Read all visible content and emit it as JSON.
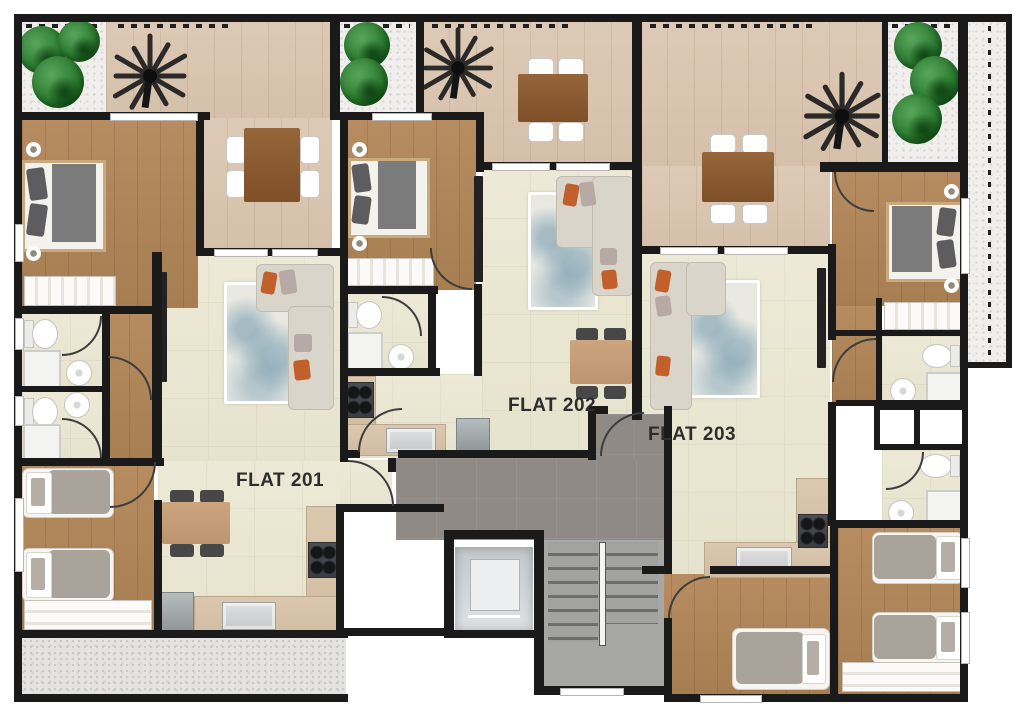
{
  "flats": [
    {
      "label": "FLAT 201"
    },
    {
      "label": "FLAT 202"
    },
    {
      "label": "FLAT 203"
    }
  ],
  "palette": {
    "wall": "#1a1a1a",
    "tile": "#ebe8d6",
    "wood": "#b68c60",
    "terrace": "#dcc8b3",
    "corridor": "#8f8a85",
    "stairs": "#a7a7a5",
    "gravel": "#efeeec",
    "green": "#2e7d32",
    "rug_blue": "#8fb3c0",
    "sofa": "#d9d5ca",
    "accent_orange": "#c2602c",
    "label": "#2d2d2d"
  },
  "icons": [
    "palm-tree",
    "shrub",
    "double-bed",
    "single-bed",
    "sofa",
    "dining-table",
    "chair",
    "toilet",
    "round-sink",
    "shower",
    "stove",
    "kitchen-sink",
    "fridge",
    "tv",
    "wardrobe",
    "elevator",
    "staircase",
    "rug",
    "door-swing"
  ]
}
